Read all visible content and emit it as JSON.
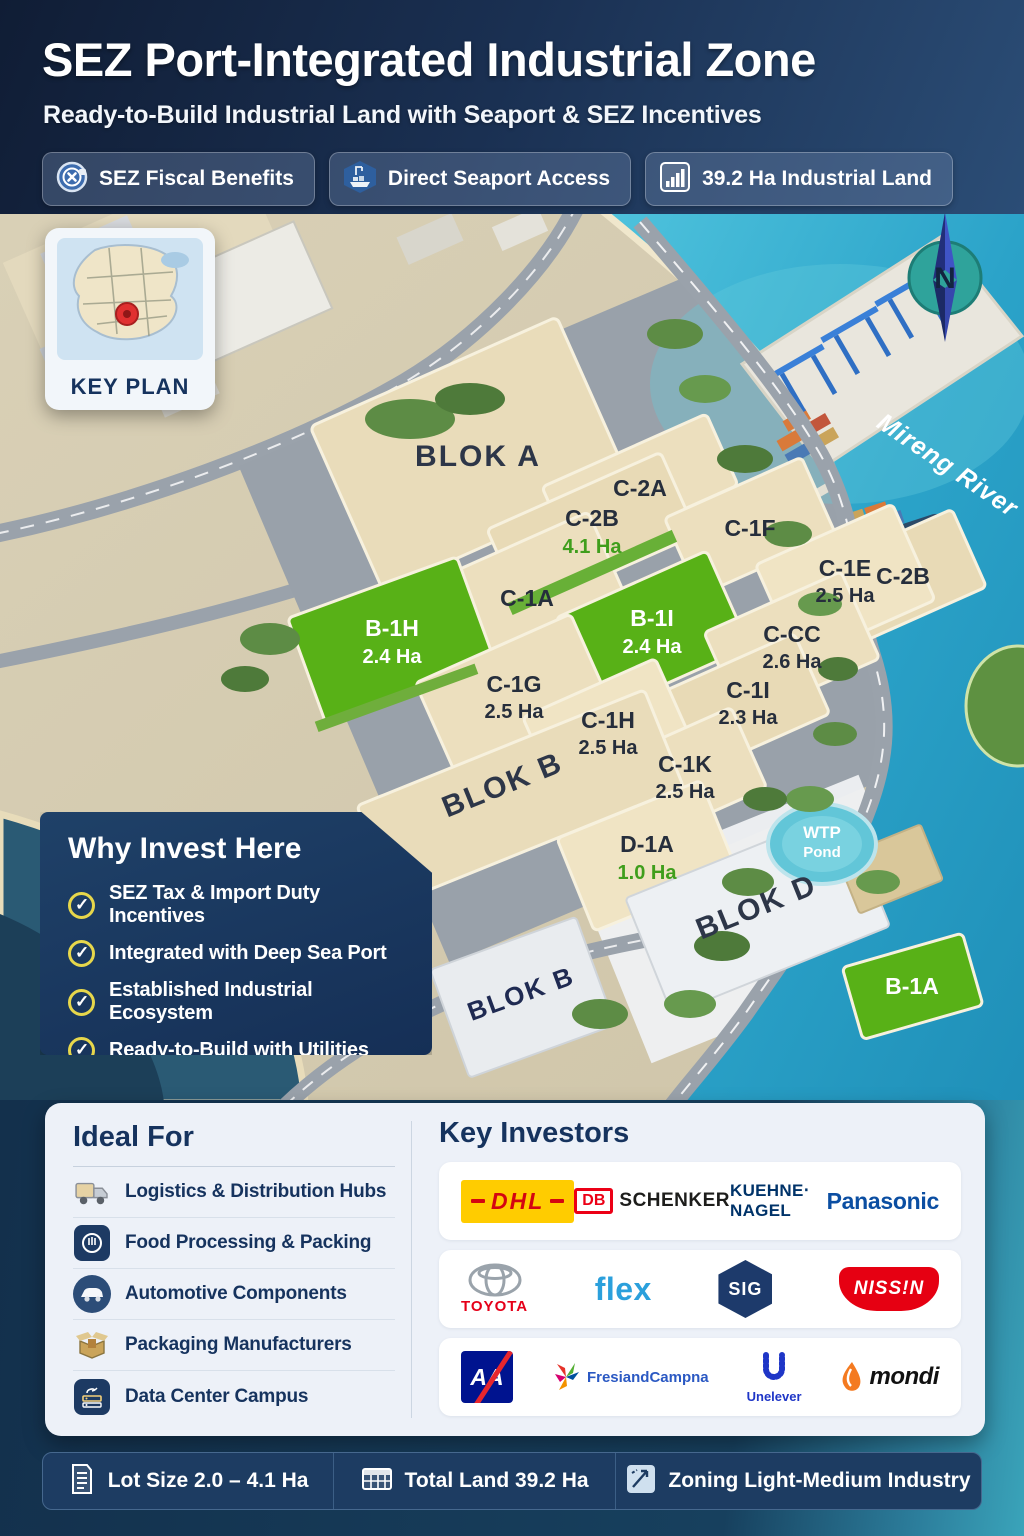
{
  "header": {
    "title": "SEZ Port-Integrated Industrial Zone",
    "subtitle": "Ready-to-Build Industrial Land with Seaport & SEZ Incentives",
    "badges": [
      {
        "icon": "coin-percent-icon",
        "label": "SEZ Fiscal Benefits"
      },
      {
        "icon": "seaport-ship-icon",
        "label": "Direct Seaport Access"
      },
      {
        "icon": "bar-chart-icon",
        "label": "39.2 Ha Industrial Land"
      }
    ]
  },
  "key_plan": {
    "label": "KEY PLAN",
    "pin_icon": "red-location-pin"
  },
  "map": {
    "river_label": "Mireng River",
    "compass_label": "N",
    "wtp_pond": {
      "line1": "WTP",
      "line2": "Pond"
    },
    "blocks": [
      "BLOK A",
      "BLOK B",
      "BLOK D",
      "BLOK B"
    ],
    "lots": [
      {
        "name": "C-2A"
      },
      {
        "name": "C-2B",
        "area": "4.1 Ha",
        "area_color": "green"
      },
      {
        "name": "C-1F"
      },
      {
        "name": "C-2B"
      },
      {
        "name": "C-1A"
      },
      {
        "name": "C-1E",
        "area": "2.5 Ha"
      },
      {
        "name": "B-1H",
        "area": "2.4 Ha",
        "lot_color": "green"
      },
      {
        "name": "B-1I",
        "area": "2.4 Ha",
        "lot_color": "green"
      },
      {
        "name": "C-CC",
        "area": "2.6 Ha"
      },
      {
        "name": "C-1G",
        "area": "2.5 Ha"
      },
      {
        "name": "C-1H",
        "area": "2.5 Ha"
      },
      {
        "name": "C-1I",
        "area": "2.3 Ha"
      },
      {
        "name": "C-1K",
        "area": "2.5 Ha"
      },
      {
        "name": "D-1A",
        "area": "1.0 Ha",
        "area_color": "green"
      },
      {
        "name": "B-1A",
        "lot_color": "green"
      }
    ]
  },
  "why_invest": {
    "title": "Why Invest Here",
    "check_icon": "yellow-ring-check",
    "items": [
      "SEZ Tax & Import Duty Incentives",
      "Integrated with Deep Sea Port",
      "Established Industrial Ecosystem",
      "Ready-to-Build with Utilities"
    ]
  },
  "ideal_for": {
    "title": "Ideal For",
    "items": [
      {
        "icon": "truck-icon",
        "label": "Logistics & Distribution Hubs"
      },
      {
        "icon": "food-processing-icon",
        "label": "Food Processing & Packing"
      },
      {
        "icon": "car-icon",
        "label": "Automotive Components"
      },
      {
        "icon": "open-box-icon",
        "label": "Packaging Manufacturers"
      },
      {
        "icon": "server-icon",
        "label": "Data Center Campus"
      }
    ]
  },
  "key_investors": {
    "title": "Key Investors",
    "logos": {
      "dhl": "DHL",
      "db": "DB",
      "schenker": "SCHENKER",
      "kuehne_nagel": "KUEHNE‧NAGEL",
      "panasonic": "Panasonic",
      "toyota": "TOYOTA",
      "flex": "flex",
      "sig": "SIG",
      "nissin": "NISS!N",
      "axa": "AA",
      "frieslandcampina": "FresiandCampna",
      "unilever": "Unelever",
      "mondi": "mondi"
    }
  },
  "stats_bar": {
    "items": [
      {
        "icon": "document-icon",
        "label": "Lot Size 2.0 – 4.1 Ha"
      },
      {
        "icon": "table-grid-icon",
        "label": "Total Land 39.2 Ha"
      },
      {
        "icon": "zoning-icon",
        "label": "Zoning Light-Medium Industry"
      }
    ]
  },
  "colors": {
    "navy": "#16335E",
    "accent_yellow": "#E7D74B",
    "water_teal": "#2BA3C9",
    "lot_tan": "#ECDFBE",
    "lot_green": "#58B117",
    "area_green": "#3F9E1C"
  }
}
